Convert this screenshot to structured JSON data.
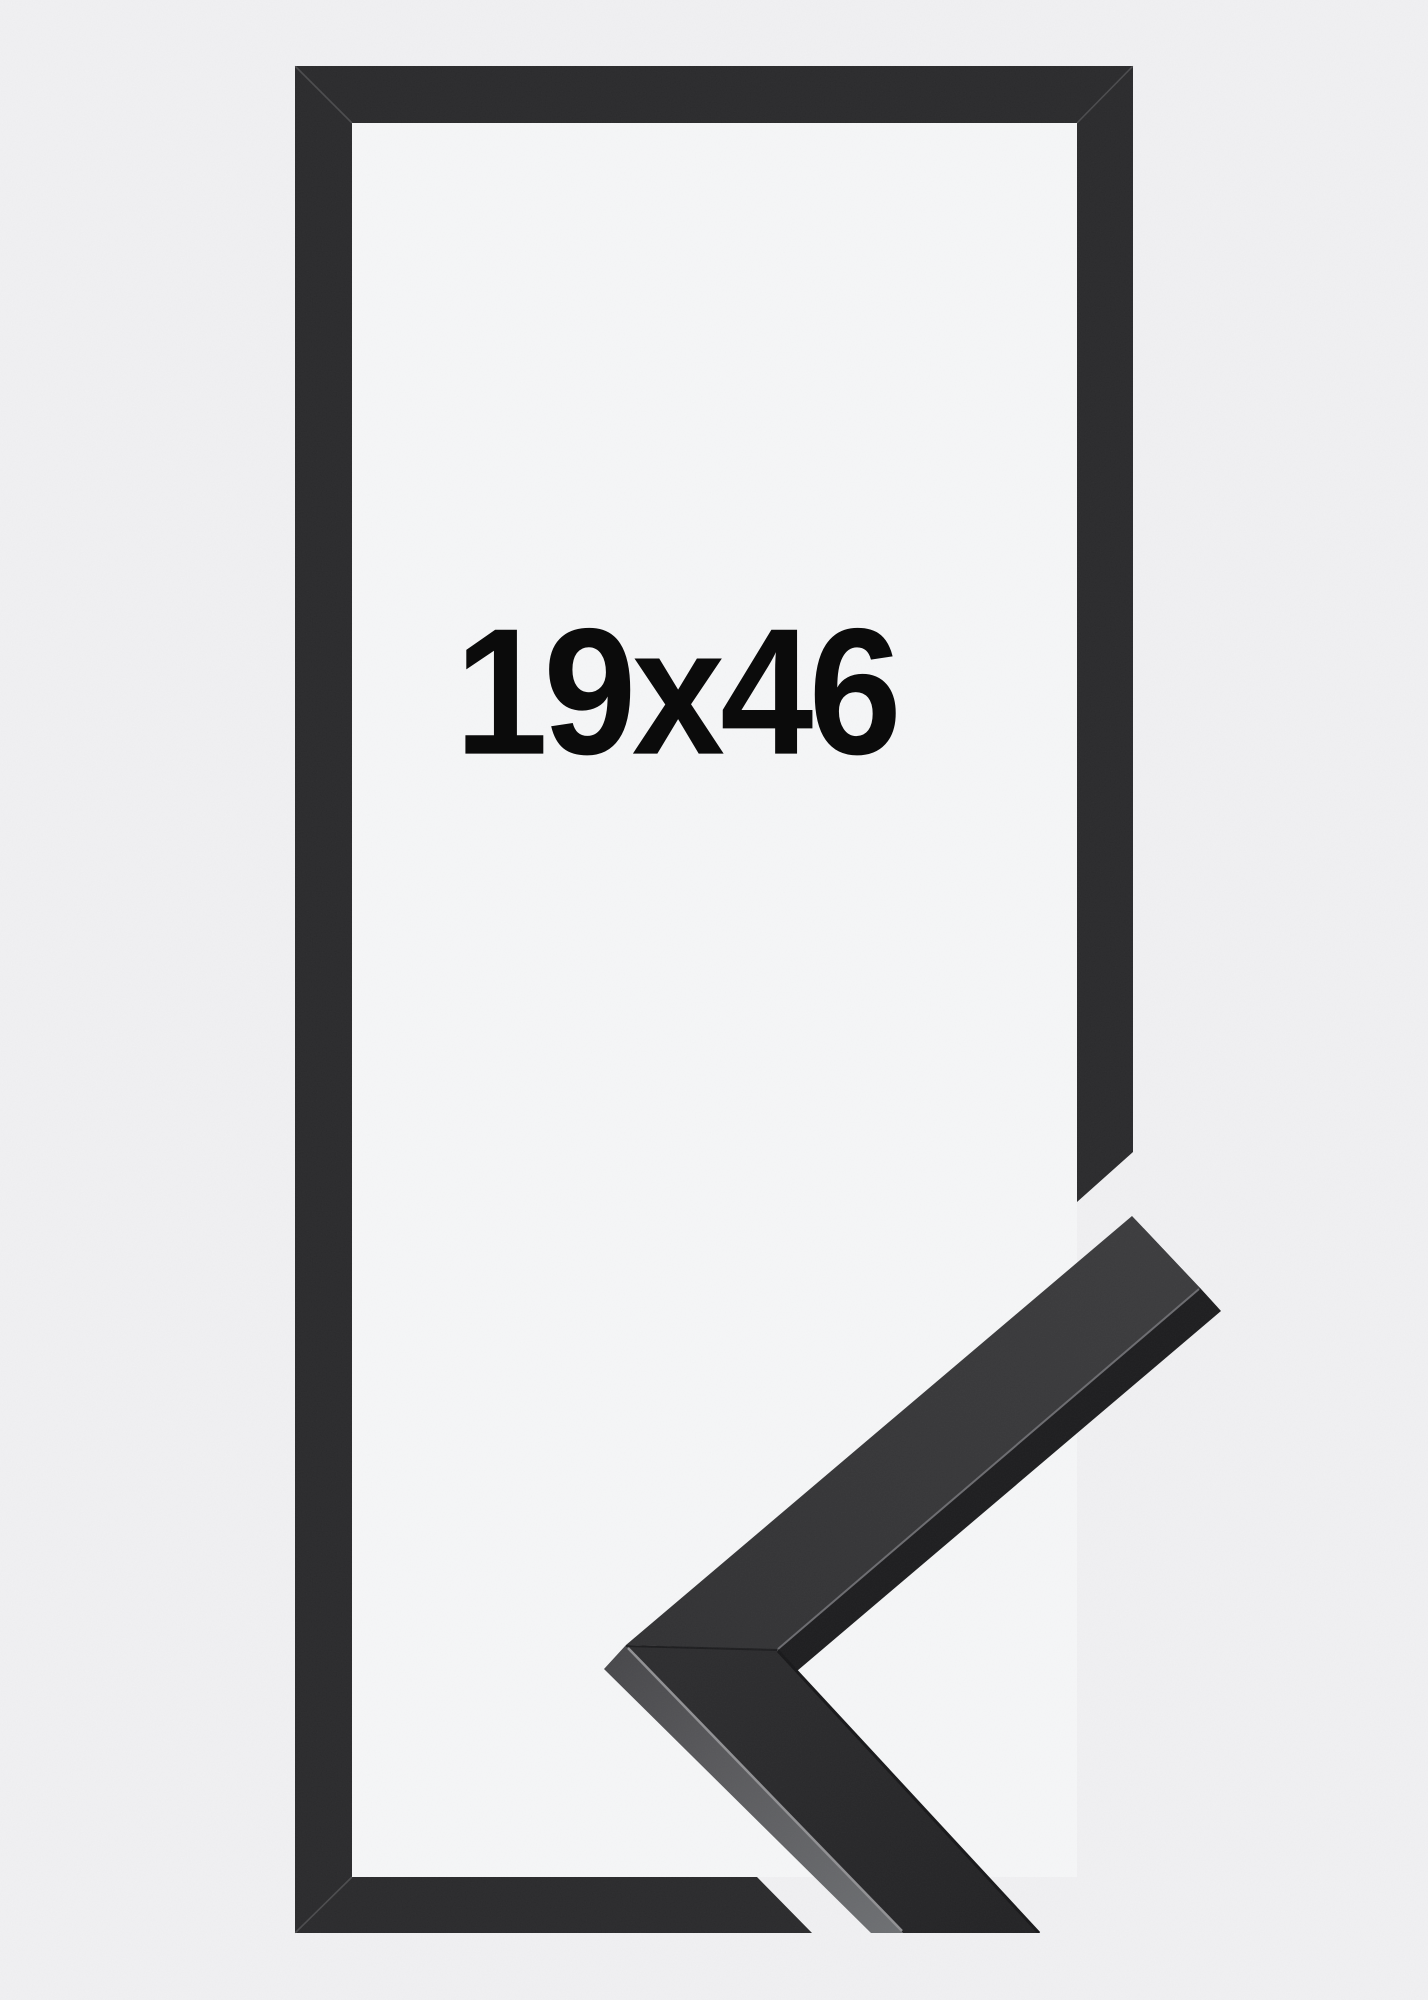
{
  "photo": {
    "size_label": "19x46",
    "colors": {
      "background": "#f0f0f2",
      "opening_backing": "#f5f6f7",
      "frame_front": "#2b2b2d",
      "profile_top_upper": "#38383a",
      "profile_top_lower": "#29292b",
      "profile_inner_side": "#1e1e20",
      "profile_outer_side": "#6e7073",
      "chamfer_highlight": "#919194",
      "label_text": "#0b0b0b"
    }
  }
}
